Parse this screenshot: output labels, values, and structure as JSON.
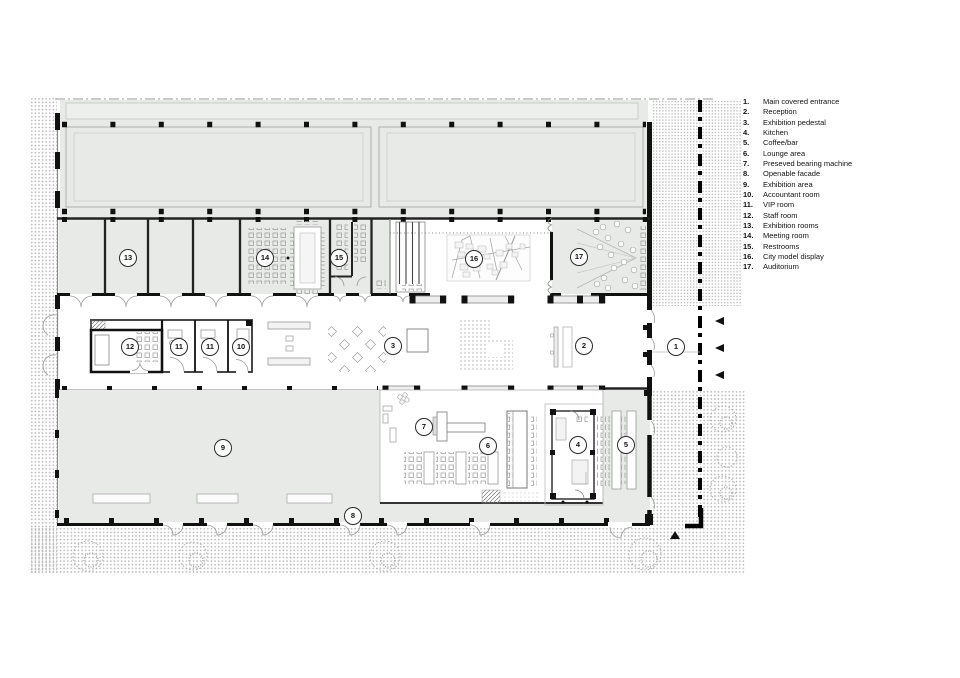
{
  "legend": {
    "items": [
      {
        "num": "1",
        "label": "Main covered entrance"
      },
      {
        "num": "2",
        "label": "Reception"
      },
      {
        "num": "3",
        "label": "Exhibition pedestal"
      },
      {
        "num": "4",
        "label": "Kitchen"
      },
      {
        "num": "5",
        "label": "Coffee/bar"
      },
      {
        "num": "6",
        "label": "Lounge area"
      },
      {
        "num": "7",
        "label": "Preseved bearing machine"
      },
      {
        "num": "8",
        "label": "Openable facade"
      },
      {
        "num": "9",
        "label": "Exhibition area"
      },
      {
        "num": "10",
        "label": "Accountant room"
      },
      {
        "num": "11",
        "label": "VIP room"
      },
      {
        "num": "12",
        "label": "Staff room"
      },
      {
        "num": "13",
        "label": "Exhibition rooms"
      },
      {
        "num": "14",
        "label": "Meeting room"
      },
      {
        "num": "15",
        "label": "Restrooms"
      },
      {
        "num": "16",
        "label": "City model display"
      },
      {
        "num": "17",
        "label": "Auditorium"
      }
    ]
  },
  "plan": {
    "markers": [
      {
        "num": "1",
        "x": 676,
        "y": 347
      },
      {
        "num": "2",
        "x": 584,
        "y": 346
      },
      {
        "num": "3",
        "x": 393,
        "y": 346
      },
      {
        "num": "4",
        "x": 578,
        "y": 445
      },
      {
        "num": "5",
        "x": 626,
        "y": 445
      },
      {
        "num": "6",
        "x": 488,
        "y": 446
      },
      {
        "num": "7",
        "x": 424,
        "y": 427
      },
      {
        "num": "8",
        "x": 353,
        "y": 516
      },
      {
        "num": "9",
        "x": 223,
        "y": 448
      },
      {
        "num": "10",
        "x": 241,
        "y": 347
      },
      {
        "num": "11",
        "x": 179,
        "y": 347
      },
      {
        "num": "11",
        "x": 210,
        "y": 347
      },
      {
        "num": "12",
        "x": 130,
        "y": 347
      },
      {
        "num": "13",
        "x": 128,
        "y": 258
      },
      {
        "num": "14",
        "x": 265,
        "y": 258
      },
      {
        "num": "15",
        "x": 339,
        "y": 258
      },
      {
        "num": "16",
        "x": 474,
        "y": 259
      },
      {
        "num": "17",
        "x": 579,
        "y": 257
      }
    ]
  },
  "colors": {
    "room_fill": "#e8eae8",
    "wall": "#111111",
    "light_line": "#9a9a9a",
    "stipple_dot": "#bdbdbd"
  }
}
